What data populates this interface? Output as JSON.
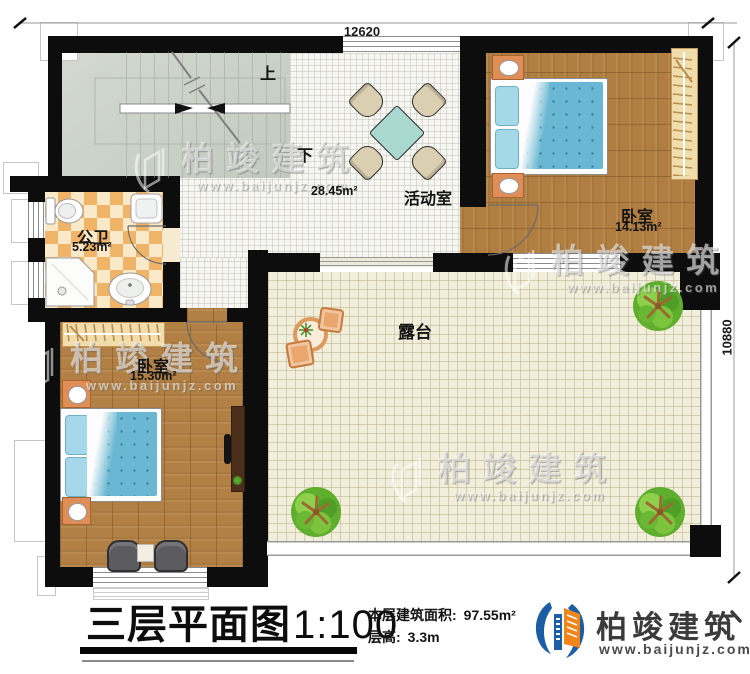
{
  "plan": {
    "dimension_top": "12620",
    "dimension_right": "10880",
    "stairs_up": "上",
    "stairs_down": "下"
  },
  "rooms": {
    "activity": {
      "name": "活动室",
      "area": "28.45m²"
    },
    "bedroom_top": {
      "name": "卧室",
      "area": "14.13m²"
    },
    "bathroom": {
      "name": "公卫",
      "area": "5.23m²"
    },
    "bedroom_bottom": {
      "name": "卧室",
      "area": "15.30m²"
    },
    "terrace": {
      "name": "露台"
    }
  },
  "title_block": {
    "title": "三层平面图",
    "scale": "1:100",
    "floor_area_label": "本层建筑面积:",
    "floor_area_value": "97.55m²",
    "floor_height_label": "层高:",
    "floor_height_value": "3.3m"
  },
  "brand": {
    "name": "柏竣建筑",
    "url": "www.baijunjz.com"
  },
  "watermark": {
    "name": "柏竣建筑",
    "url": "www.baijunjz.com"
  },
  "colors": {
    "wall": "#0d0d0d",
    "wood_floor": "#b28044",
    "stair_floor": "#ccd3c9",
    "terrace_floor": "#f1eedb",
    "bath_tile": "#efb468",
    "bed_blue": "#69b7d2",
    "brand_blue": "#1b5ea6",
    "brand_orange": "#f08519"
  }
}
